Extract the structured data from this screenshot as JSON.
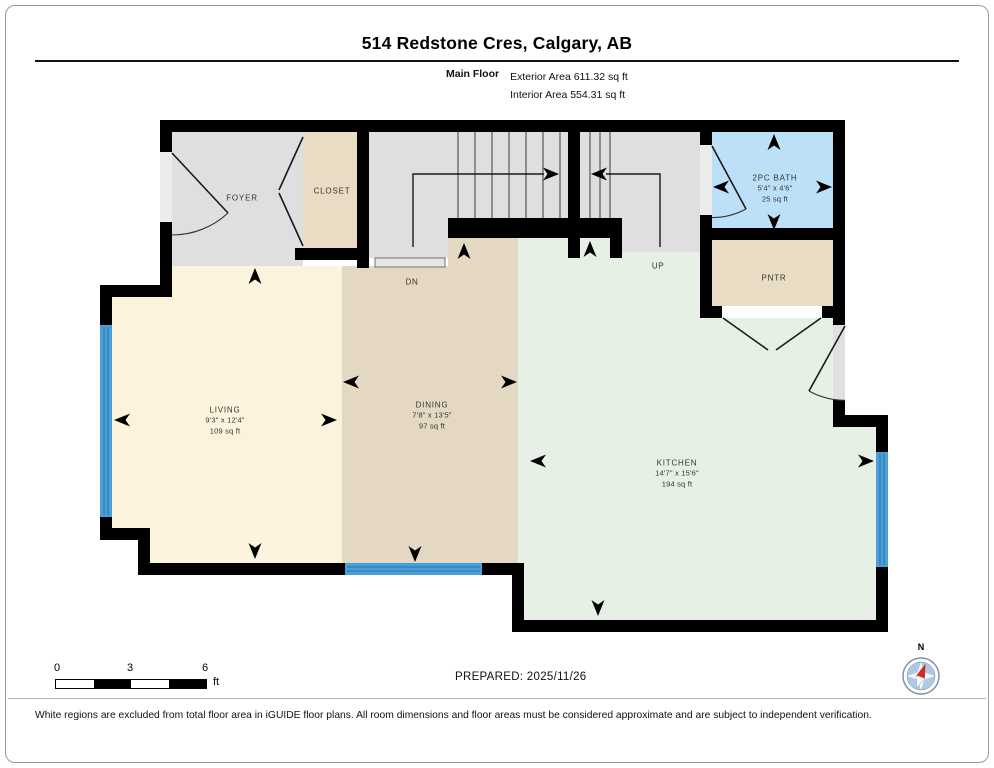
{
  "header": {
    "title": "514 Redstone Cres, Calgary, AB",
    "floor_label": "Main Floor",
    "exterior_area": "Exterior Area 611.32 sq ft",
    "interior_area": "Interior Area 554.31 sq ft"
  },
  "rooms": {
    "foyer": {
      "name": "FOYER"
    },
    "closet": {
      "name": "CLOSET"
    },
    "bath": {
      "name": "2PC BATH",
      "dimensions": "5'4\" x 4'6\"",
      "area": "25 sq ft"
    },
    "pantry": {
      "name": "PNTR"
    },
    "living": {
      "name": "LIVING",
      "dimensions": "9'3\" x 12'4\"",
      "area": "109 sq ft"
    },
    "dining": {
      "name": "DINING",
      "dimensions": "7'8\" x 13'5\"",
      "area": "97 sq ft"
    },
    "kitchen": {
      "name": "KITCHEN",
      "dimensions": "14'7\" x 15'6\"",
      "area": "194 sq ft"
    }
  },
  "stairs": {
    "up_label": "UP",
    "down_label": "DN"
  },
  "scale_bar": {
    "start": "0",
    "mid": "3",
    "end": "6",
    "unit": "ft"
  },
  "compass": {
    "label": "N"
  },
  "footer": {
    "prepared": "PREPARED: 2025/11/26",
    "disclaimer": "White regions are excluded from total floor area in iGUIDE floor plans. All room dimensions and floor areas must be considered approximate and are subject to independent verification."
  },
  "colors": {
    "wall": "#000000",
    "floor_gray": "#dfdfdf",
    "living": "#fbf3dc",
    "dining": "#e5d8c2",
    "kitchen": "#e6f0e5",
    "bath": "#bce0f8",
    "closet": "#e9dcc5",
    "pantry": "#e9dcc5",
    "window": "#4a9fd8",
    "compass_needle": "#cf2b1e"
  }
}
